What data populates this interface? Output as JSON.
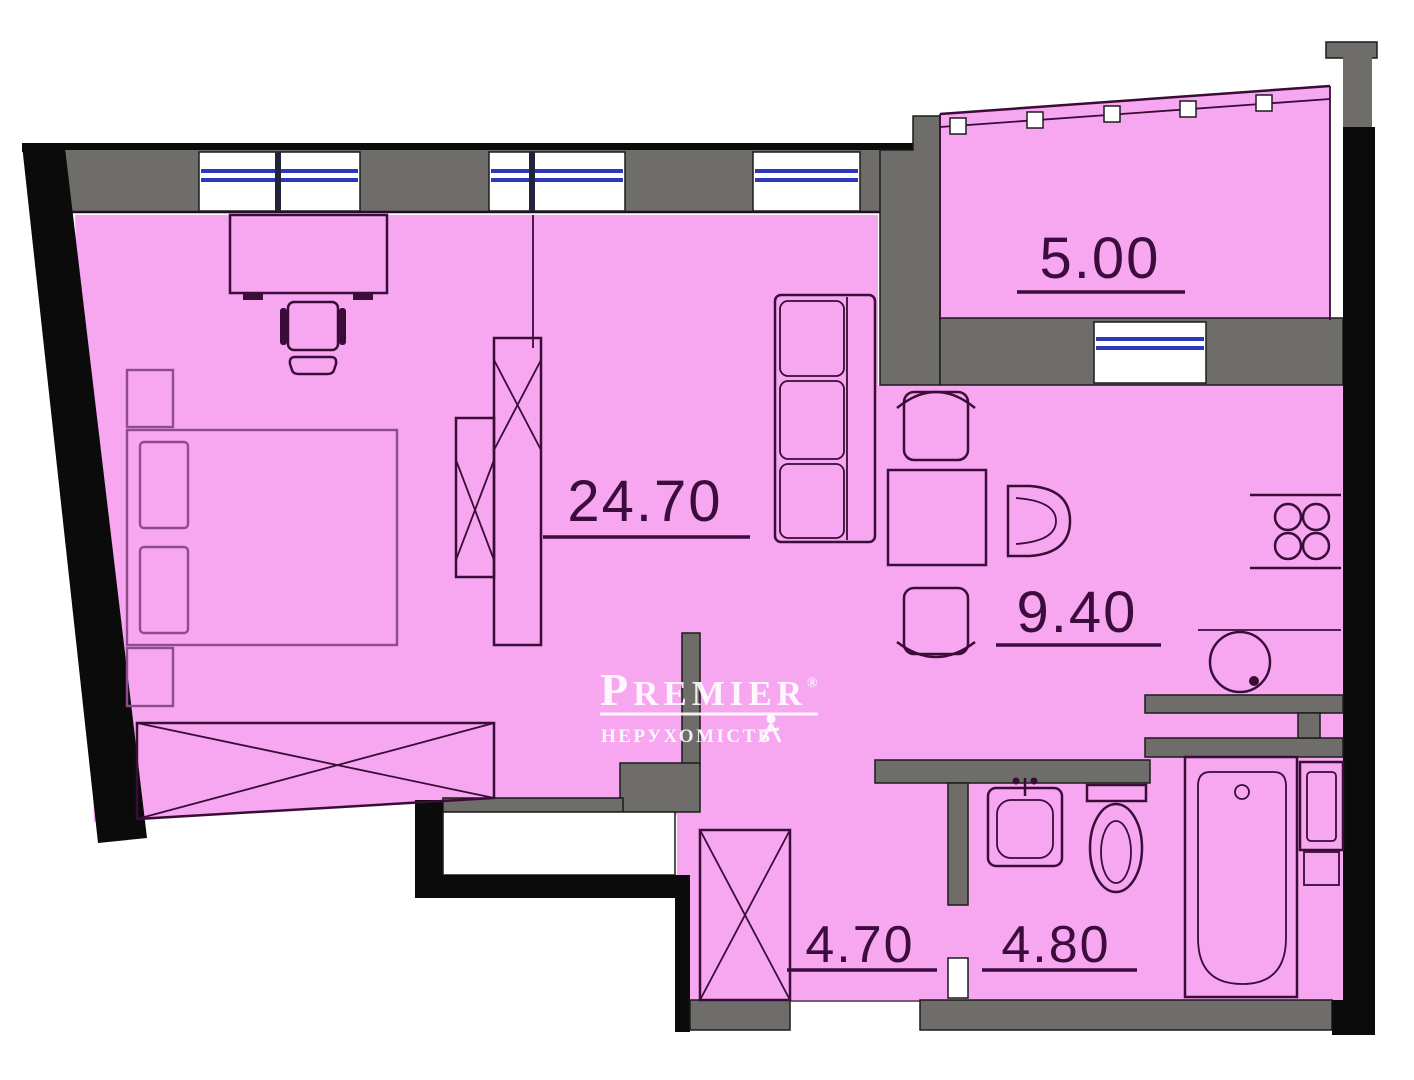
{
  "title": "apartment-floor-plan",
  "rooms": [
    {
      "name": "living-bedroom-studio",
      "area": "24.70"
    },
    {
      "name": "balcony",
      "area": "5.00"
    },
    {
      "name": "kitchen-dining",
      "area": "9.40"
    },
    {
      "name": "hallway",
      "area": "4.70"
    },
    {
      "name": "bathroom",
      "area": "4.80"
    }
  ],
  "watermark": {
    "brand_initial": "P",
    "brand_rest": "REMIER",
    "registered": "®",
    "subtitle": "НЕРУХОМІСТЬ"
  },
  "colors": {
    "room_fill": "#f6a7f0",
    "wall_gray": "#6f6d6a",
    "wall_black": "#0b0b0b",
    "window_blue": "#2c38b8",
    "line_dark": "#3a0c38",
    "line_medium": "#8e4c8c",
    "label": "#3c0c3c",
    "watermark": "#ffffff"
  }
}
